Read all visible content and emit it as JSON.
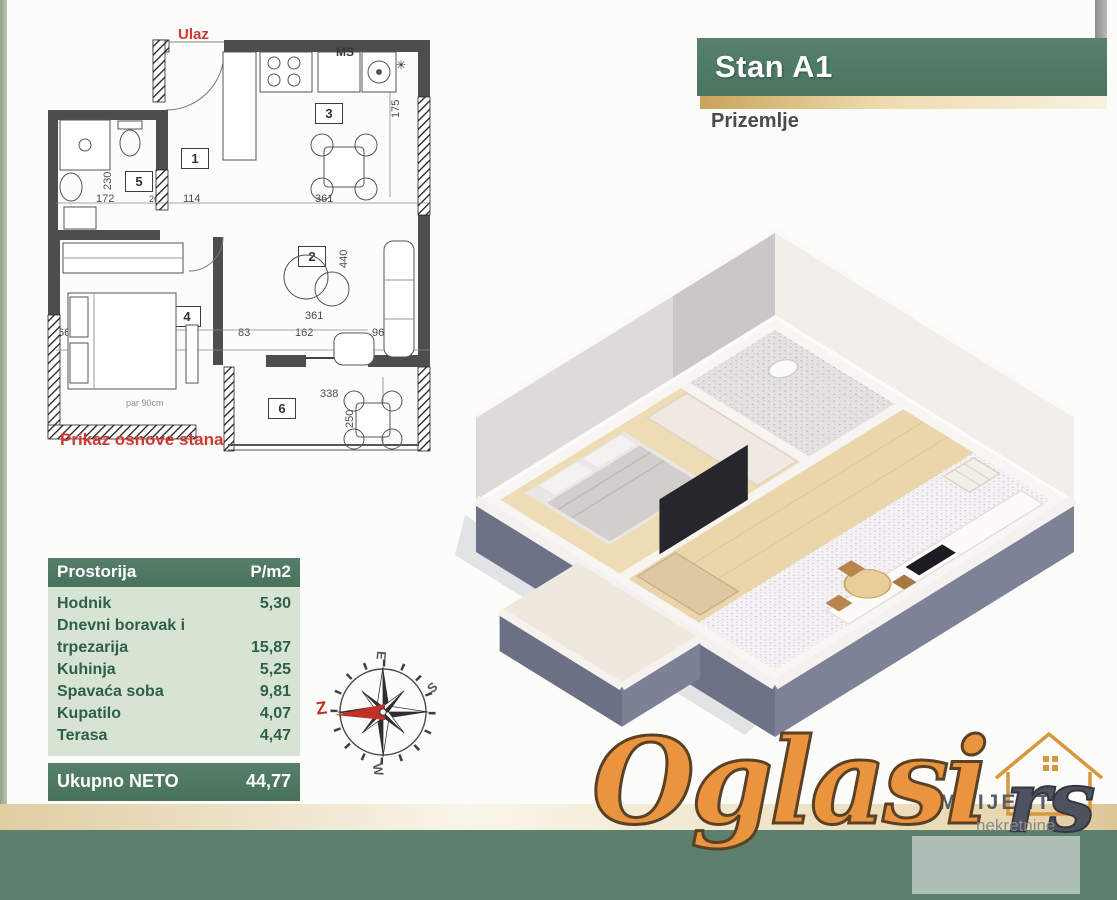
{
  "header": {
    "title": "Stan A1",
    "subtitle": "Prizemlje"
  },
  "floor_plan": {
    "entrance_label": "Ulaz",
    "caption": "Prikaz osnove stana",
    "note": "par 90cm",
    "rooms": {
      "r1": "1",
      "r2": "2",
      "r3": "3",
      "r4": "4",
      "r5": "5",
      "r6": "6"
    },
    "appliances": {
      "ms_label": "MS",
      "boiler_symbol": "✳"
    },
    "dims": {
      "d172": "172",
      "d26": "26",
      "d114": "114",
      "d361a": "361",
      "d299": "299",
      "d361b": "361",
      "d66": "66",
      "d142": "142",
      "d91": "91",
      "d83": "83",
      "d162": "162",
      "d96": "96",
      "d175": "175",
      "d230": "230",
      "d328": "328",
      "d440": "440",
      "d338": "338",
      "d250": "250"
    }
  },
  "area_table": {
    "header": {
      "room": "Prostorija",
      "area": "P/m2"
    },
    "rows": [
      {
        "room": "Hodnik",
        "area": "5,30"
      },
      {
        "room": "Dnevni boravak i trpezarija",
        "area": "15,87"
      },
      {
        "room": "Kuhinja",
        "area": "5,25"
      },
      {
        "room": "Spavaća soba",
        "area": "9,81"
      },
      {
        "room": "Kupatilo",
        "area": "4,07"
      },
      {
        "room": "Terasa",
        "area": "4,47"
      }
    ],
    "footer": {
      "label": "Ukupno NETO",
      "value": "44,77"
    }
  },
  "compass": {
    "top": "E",
    "right": "S",
    "bottom": "W",
    "left": "Z"
  },
  "watermark": {
    "brand": "Oglasi",
    "tld": "rs",
    "agency": "AMBIJENTI",
    "agency_sub": "nekretnine"
  },
  "colors": {
    "brand_green": "#4d7a64",
    "table_light_green": "#d7e3d3",
    "gold": "#c9a45a",
    "watermark_orange": "#ea9440",
    "footer_green": "#5d7f6e",
    "label_red": "#cf3a32"
  }
}
